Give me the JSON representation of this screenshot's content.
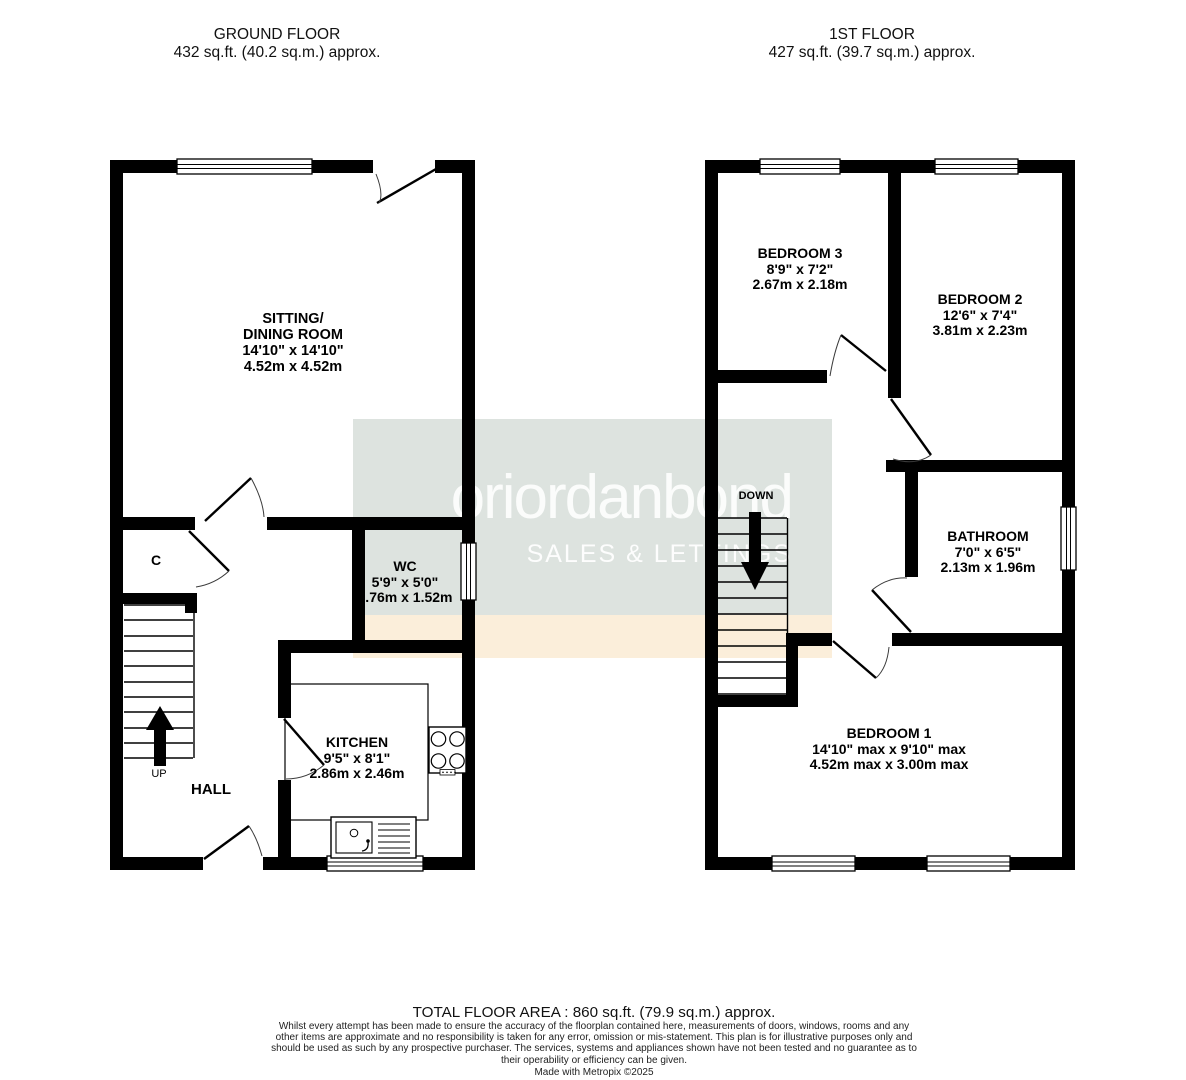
{
  "headers": {
    "ground": {
      "title": "GROUND FLOOR",
      "area": "432 sq.ft. (40.2 sq.m.) approx."
    },
    "first": {
      "title": "1ST FLOOR",
      "area": "427 sq.ft. (39.7 sq.m.) approx."
    }
  },
  "watermark": {
    "brand": "oriordanbond",
    "tagline": "SALES & LETTINGS",
    "band_gray": "#dde3df",
    "band_cream": "#fbeeda",
    "text_color": "#ffffff"
  },
  "ground_floor": {
    "sitting_dining": {
      "line1": "SITTING/",
      "line2": "DINING ROOM",
      "dims_ft": "14'10\" x 14'10\"",
      "dims_m": "4.52m x 4.52m"
    },
    "wc": {
      "name": "WC",
      "dims_ft": "5'9\" x 5'0\"",
      "dims_m": "1.76m x 1.52m"
    },
    "kitchen": {
      "name": "KITCHEN",
      "dims_ft": "9'5\" x 8'1\"",
      "dims_m": "2.86m x 2.46m"
    },
    "hall": "HALL",
    "cupboard": "C",
    "up": "UP"
  },
  "first_floor": {
    "bedroom3": {
      "name": "BEDROOM 3",
      "dims_ft": "8'9\" x 7'2\"",
      "dims_m": "2.67m x 2.18m"
    },
    "bedroom2": {
      "name": "BEDROOM 2",
      "dims_ft": "12'6\" x 7'4\"",
      "dims_m": "3.81m x 2.23m"
    },
    "bathroom": {
      "name": "BATHROOM",
      "dims_ft": "7'0\" x 6'5\"",
      "dims_m": "2.13m x 1.96m"
    },
    "bedroom1": {
      "name": "BEDROOM 1",
      "dims_ft": "14'10\" max x 9'10\" max",
      "dims_m": "4.52m max x 3.00m max"
    },
    "down": "DOWN"
  },
  "footer": {
    "total": "TOTAL FLOOR AREA : 860 sq.ft. (79.9 sq.m.) approx.",
    "disclaimer": "Whilst every attempt has been made to ensure the accuracy of the floorplan contained here, measurements of doors, windows, rooms and any other items are approximate and no responsibility is taken for any error, omission or mis-statement. This plan is for illustrative purposes only and should be used as such by any prospective purchaser. The services, systems and appliances shown have not been tested and no guarantee as to their operability or efficiency can be given.",
    "credit": "Made with Metropix ©2025"
  },
  "colors": {
    "wall": "#000000",
    "label_text": "#000000"
  }
}
